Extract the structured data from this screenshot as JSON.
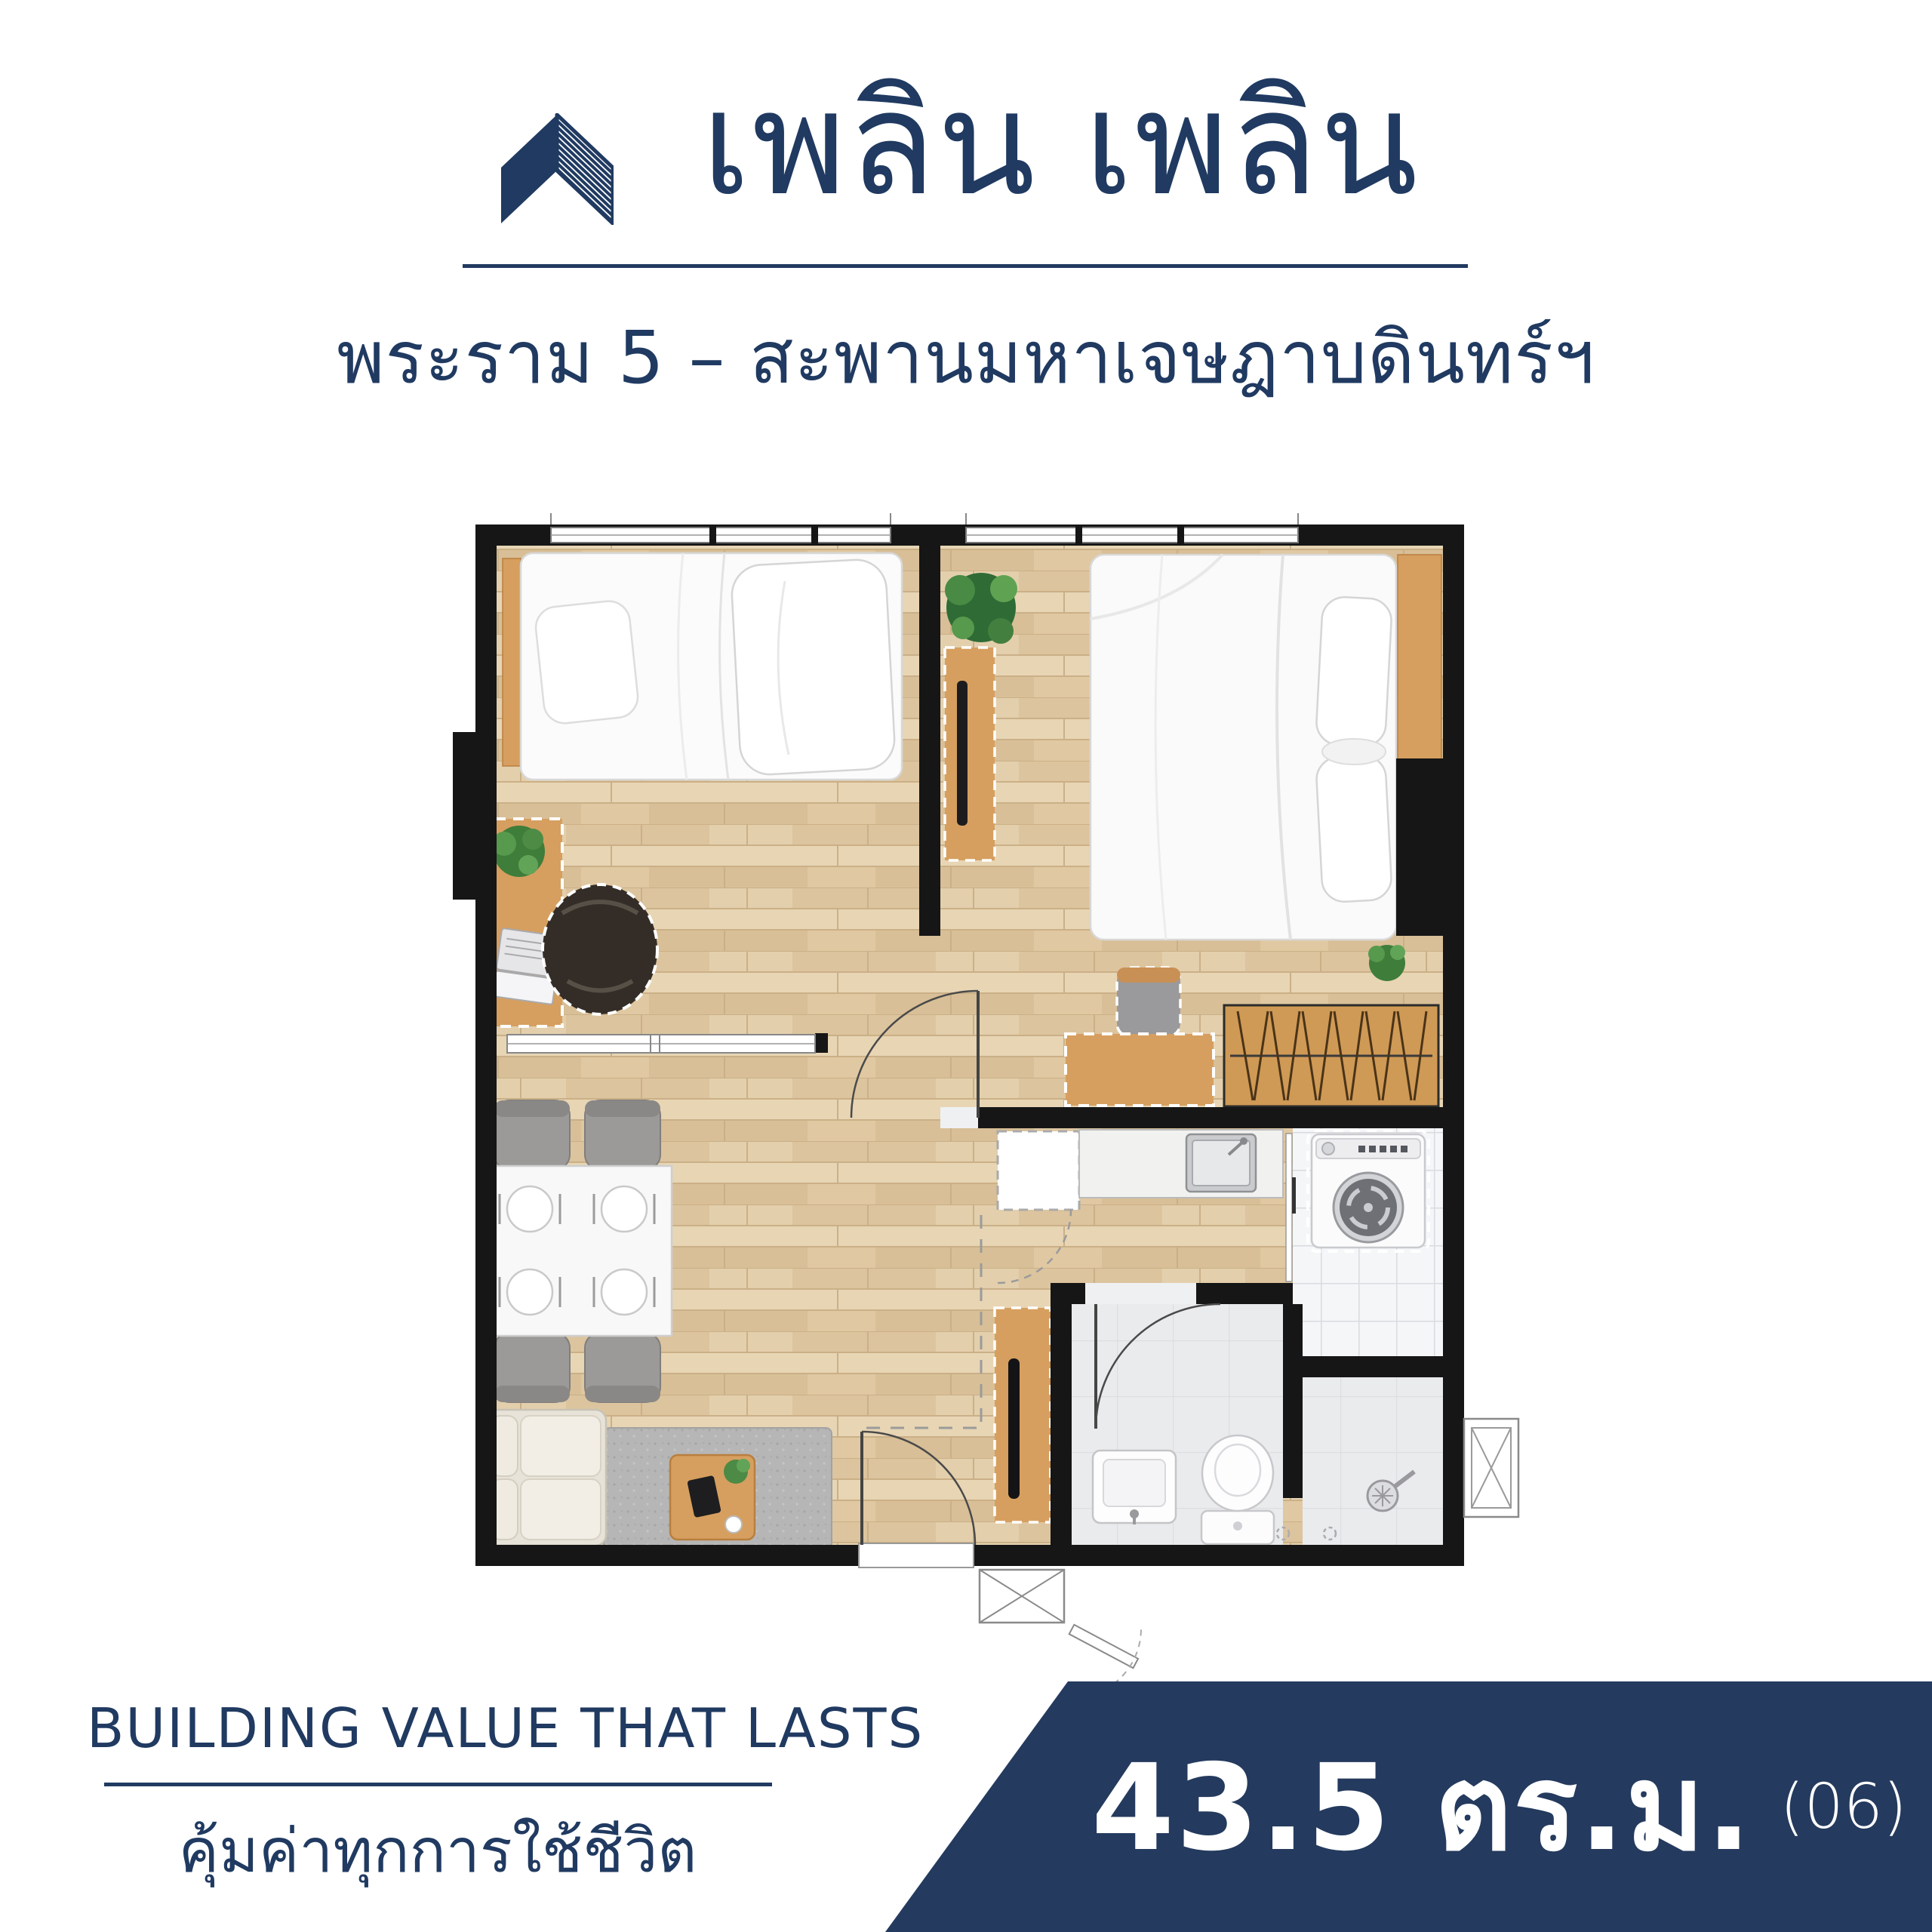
{
  "header": {
    "logo_icon": "roof-chevron-logo",
    "title": "เพลิน เพลิน",
    "subtitle": "พระราม 5 – สะพานมหาเจษฎาบดินทร์ฯ"
  },
  "footer": {
    "tagline_en": "BUILDING VALUE THAT LASTS",
    "tagline_th": "คุ้มค่าทุกการใช้ชีวิต"
  },
  "area_banner": {
    "area_value": "43.5 ตร.ม.",
    "unit_number": "(06)"
  },
  "colors": {
    "brand_navy": "#203A61",
    "banner_navy": "#243A5E",
    "wall_black": "#161616",
    "wood_floor": "#E0CBA8",
    "furniture_wood": "#D69F5F",
    "tile_white": "#F5F6F8",
    "bathroom_gray": "#EAEBED",
    "text_white": "#FFFFFF"
  },
  "floor_plan": {
    "rooms": [
      "bedroom-1",
      "bedroom-2",
      "living-dining",
      "kitchen",
      "bathroom",
      "laundry-drying-yard"
    ],
    "furniture": [
      "single-bed",
      "double-bed",
      "work-desk",
      "office-chair",
      "dining-table-4-seats",
      "sofa",
      "rug",
      "coffee-table",
      "tv-console",
      "wardrobe",
      "dressing-desk",
      "kitchen-counter",
      "sink",
      "refrigerator",
      "washing-machine",
      "toilet",
      "wash-basin",
      "shower",
      "air-conditioner-unit",
      "plants"
    ]
  }
}
